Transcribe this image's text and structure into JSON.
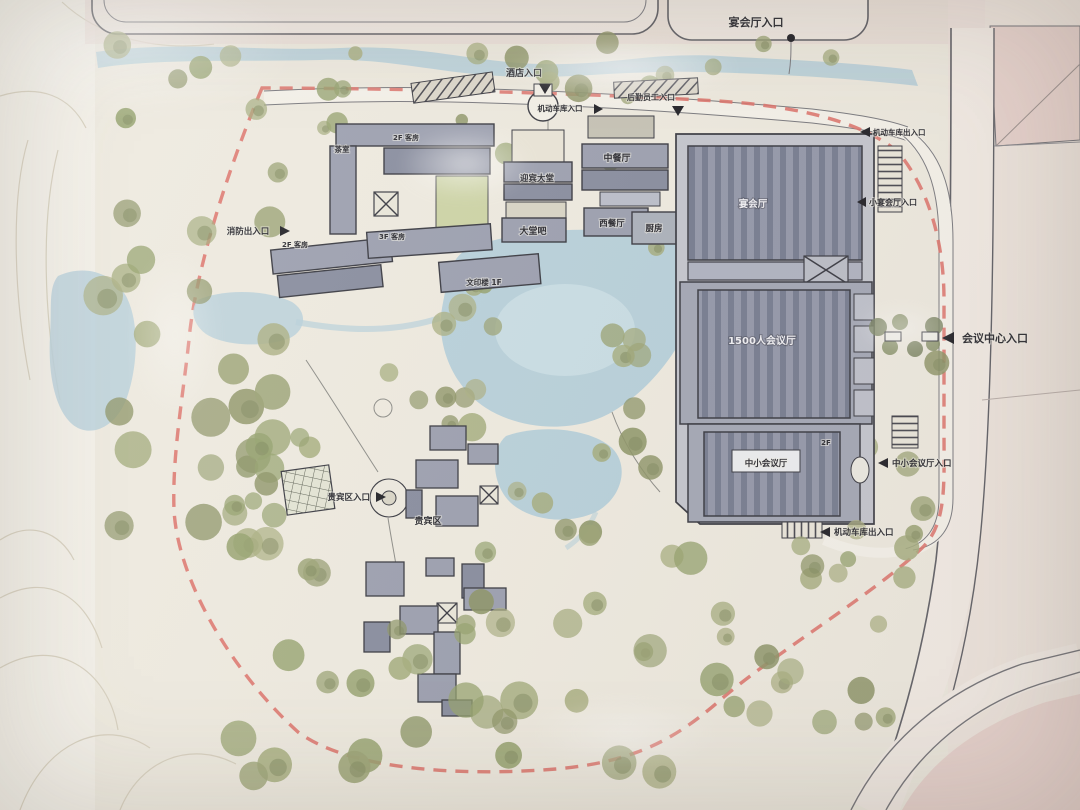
{
  "plan": {
    "type": "architectural site plan photo",
    "labels": {
      "entrances": [
        {
          "id": "banquet-hall-entrance",
          "text": "宴会厅入口"
        },
        {
          "id": "hotel-entrance",
          "text": "酒店入口"
        },
        {
          "id": "garage-entrance",
          "text": "机动车库入口"
        },
        {
          "id": "staff-entrance",
          "text": "后勤员工入口"
        },
        {
          "id": "garage-exit-ne",
          "text": "机动车库出入口"
        },
        {
          "id": "small-banquet-entrance",
          "text": "小宴会厅入口"
        },
        {
          "id": "conference-center-entrance",
          "text": "会议中心入口"
        },
        {
          "id": "small-medium-hall-entrance",
          "text": "中小会议厅入口"
        },
        {
          "id": "garage-exit-se",
          "text": "机动车库出入口"
        },
        {
          "id": "vip-entrance",
          "text": "贵宾区入口"
        },
        {
          "id": "fire-exit",
          "text": "消防出入口"
        }
      ],
      "buildings": [
        {
          "id": "chinese-restaurant",
          "text": "中餐厅"
        },
        {
          "id": "welcome-lobby",
          "text": "迎宾大堂"
        },
        {
          "id": "lobby-bar",
          "text": "大堂吧"
        },
        {
          "id": "western-restaurant",
          "text": "西餐厅"
        },
        {
          "id": "kitchen",
          "text": "厨房"
        },
        {
          "id": "banquet-hall",
          "text": "宴会厅"
        },
        {
          "id": "grand-hall",
          "text": "1500人会议厅"
        },
        {
          "id": "small-medium-hall",
          "text": "中小会议厅"
        },
        {
          "id": "vip-area",
          "text": "贵宾区"
        },
        {
          "id": "print-building",
          "text": "文印楼 1F"
        },
        {
          "id": "tea-room",
          "text": "茶室"
        },
        {
          "id": "guestroom-2f-a",
          "text": "2F 客房"
        },
        {
          "id": "guestroom-3f",
          "text": "3F 客房"
        },
        {
          "id": "guestroom-2f-b",
          "text": "2F 客房"
        },
        {
          "id": "floor-2f",
          "text": "2F"
        }
      ]
    },
    "colors": {
      "paper": "#eeeadf",
      "paper_light": "#f4f1e9",
      "road_pink": "#eadbd6",
      "parcel_pink": "#e8d3cd",
      "water": "#b7d0da",
      "water_light": "#cfe2e8",
      "tree": "#a6ab7d",
      "tree_dark": "#859061",
      "building": "#9a9eae",
      "roof_dark": "#747a8e",
      "outline": "#35363e",
      "boundary_red": "#dd6f68",
      "label": "#26262c",
      "lawn": "#ccd3a4"
    }
  }
}
